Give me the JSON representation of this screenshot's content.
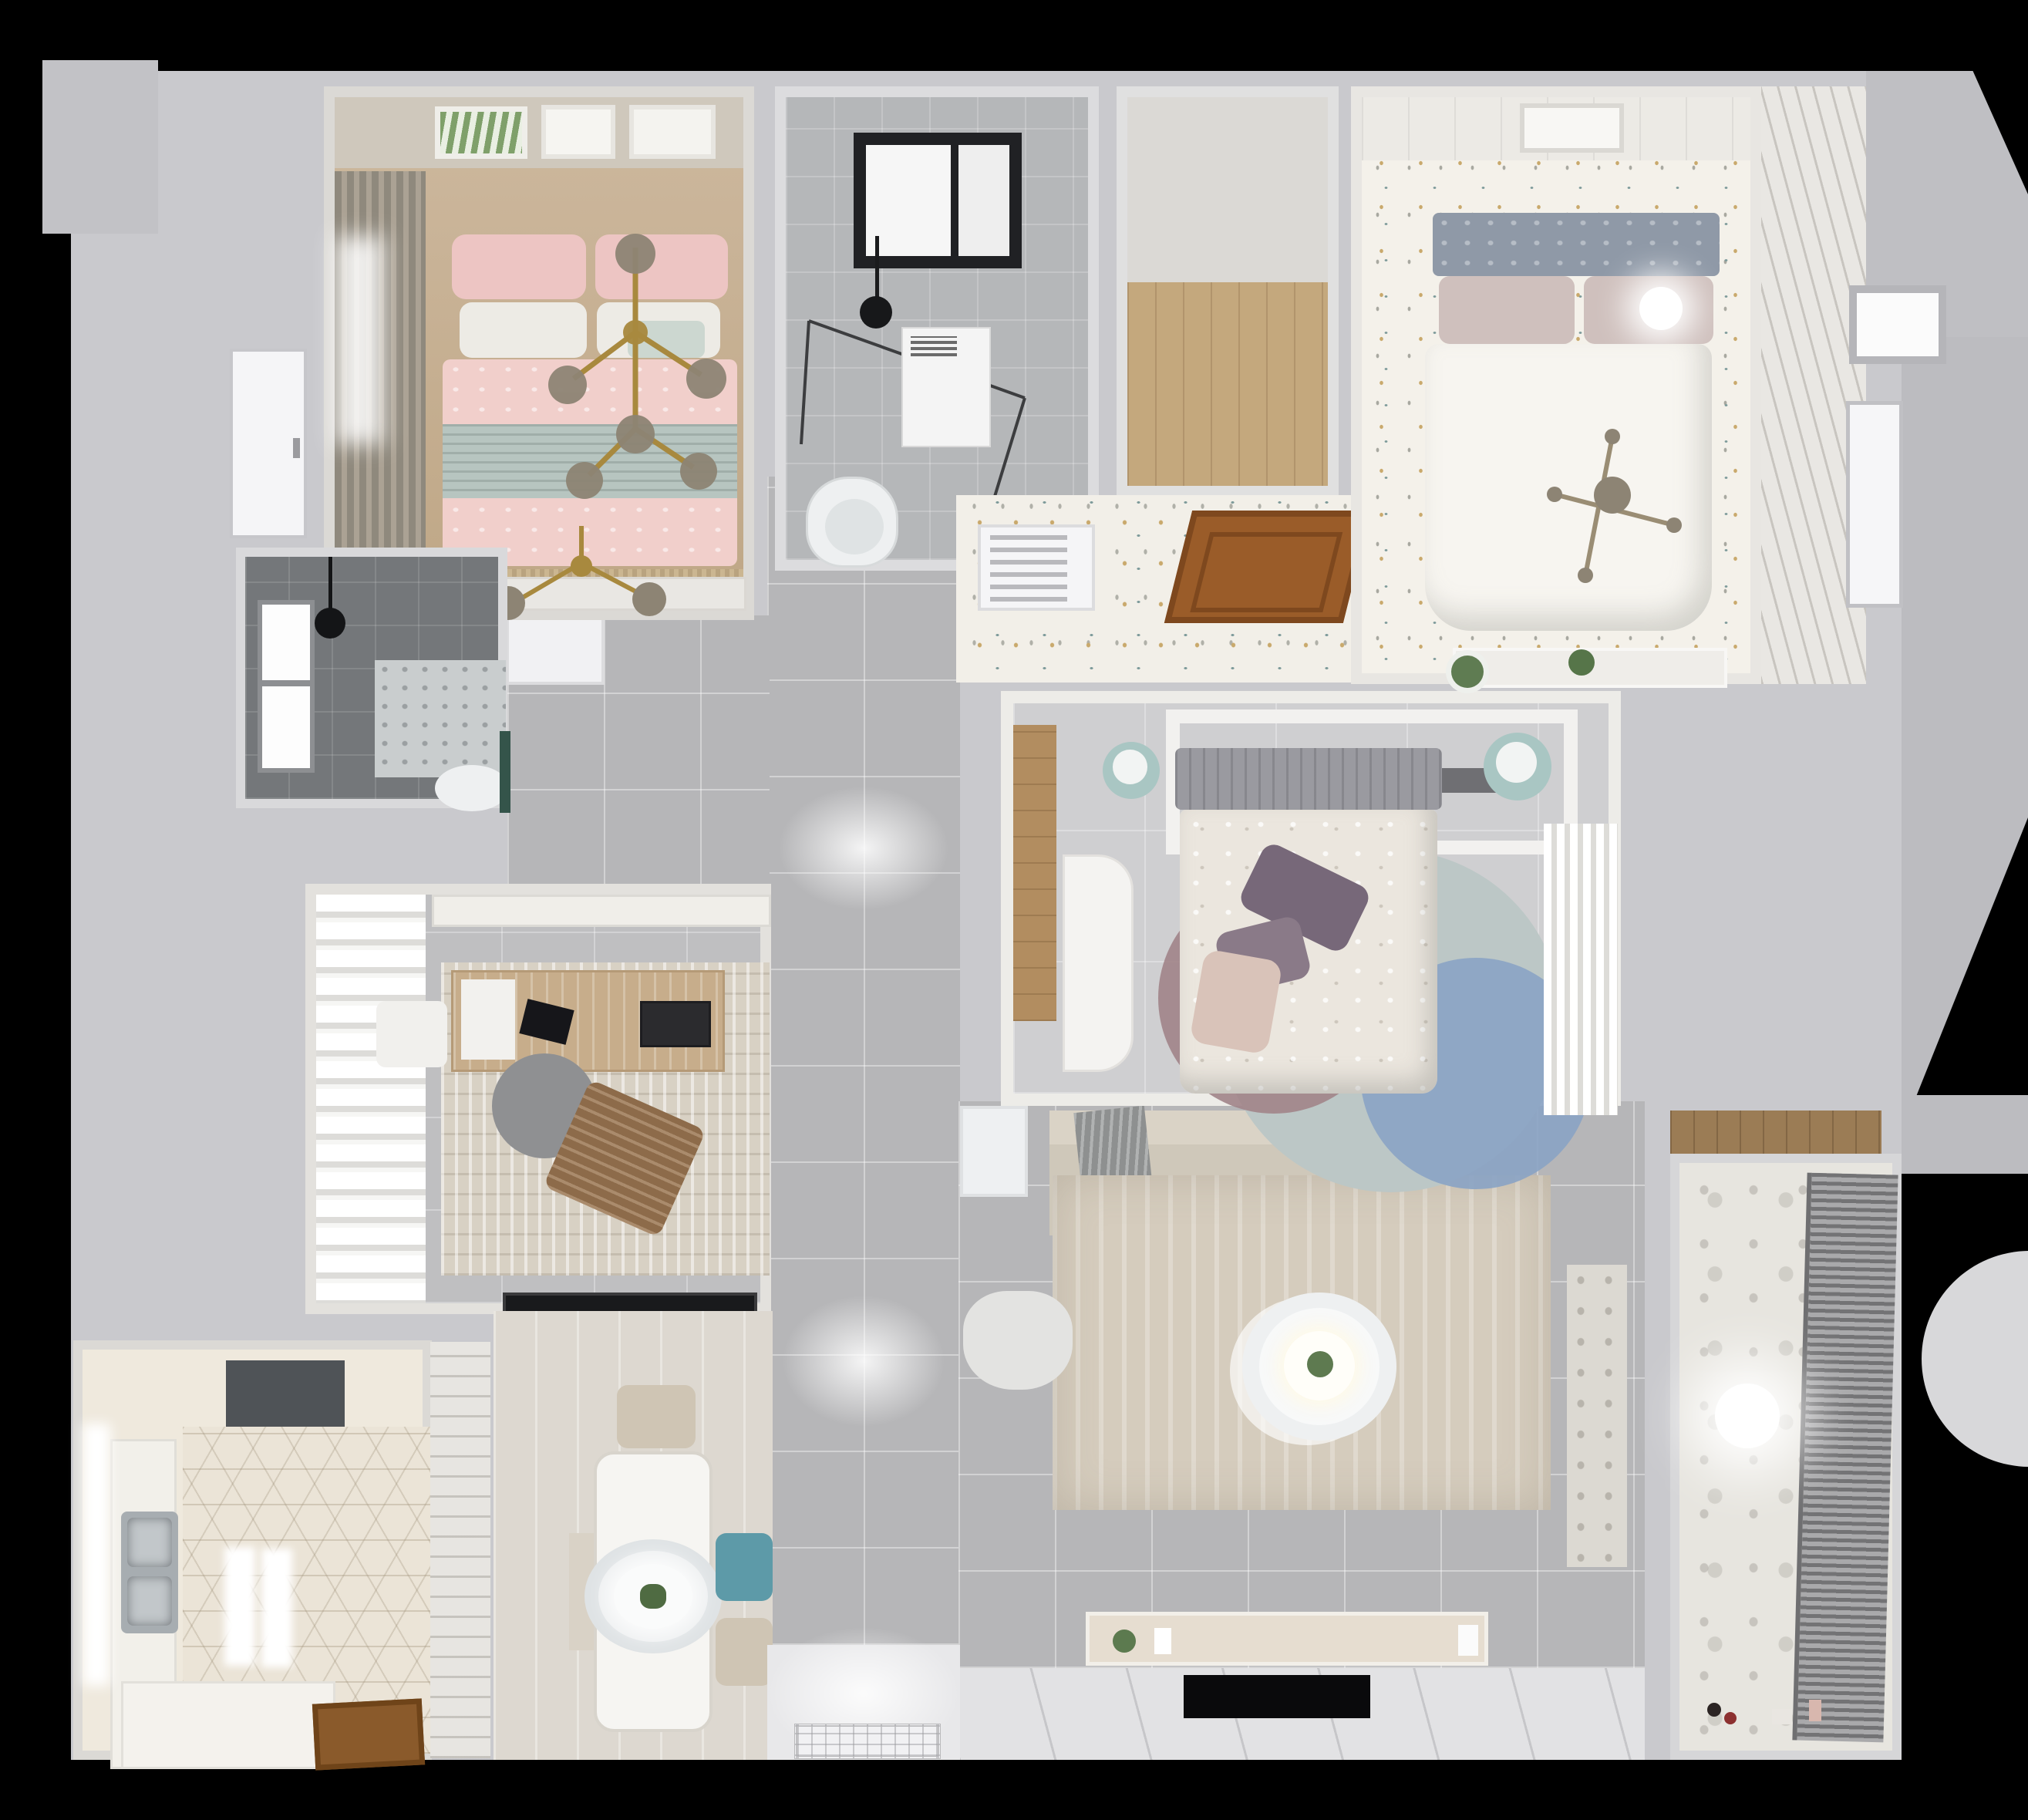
{
  "scene": {
    "type": "3d-floor-plan-top-view",
    "text_visible": "",
    "palette": {
      "background": "#000000",
      "wall_gray": "#c9c9cd",
      "wall_white": "#f2f1ef",
      "corridor_tile": "#b6b6b8",
      "speckle_floor": "#f2efe8",
      "wood_floor": "#c8b499",
      "wood_door": "#9a5c29",
      "pink_bedding": "#f1cfcb",
      "sage_throw": "#b7c5c0",
      "teal_chair": "#5d9aa8",
      "mint_pouf": "#a9c6c3",
      "purple_pillow": "#776879",
      "blue_rug": "#8aa3c4",
      "mauve_rug": "#a2868a",
      "beige_sofa": "#cfc8ba",
      "rug_beige": "#d5ccbd",
      "dark_tile": "#74777a",
      "hex_tile": "#ebe4d7",
      "blinds_gray": "#8a8a8c",
      "gold_chandelier": "#a8893e",
      "tv_black": "#0a0a0c"
    }
  },
  "rooms": [
    {
      "name": "bedroom-pink",
      "position": "top-left",
      "floor": "wood",
      "furniture": [
        "double-bed-pink-duvet",
        "pink-pillows",
        "white-pillows",
        "mint-cushion",
        "sage-throw",
        "branch-chandelier",
        "second-branch-chandelier",
        "wall-art-frames-3",
        "dark-curtains",
        "window",
        "bench",
        "fringe-rug",
        "white-door"
      ]
    },
    {
      "name": "bathroom-main",
      "position": "top-center",
      "floor": "gray-marble-tile",
      "furniture": [
        "black-framed-skylight",
        "shower-glass-enclosure",
        "black-shower-head",
        "washing-machine",
        "toilet"
      ]
    },
    {
      "name": "walk-in-closet",
      "position": "top-center-right",
      "floor": "wood-planks",
      "furniture": []
    },
    {
      "name": "foyer-hall",
      "position": "center-top",
      "floor": "speckled-terrazzo",
      "furniture": [
        "air-vent-grille",
        "open-wood-door",
        "console-shelf",
        "potted-plant"
      ]
    },
    {
      "name": "bedroom-white",
      "position": "top-right",
      "floor": "speckled-confetti",
      "furniture": [
        "double-bed-white-duvet",
        "gray-tufted-headboard",
        "blush-pillows",
        "ceiling-lamp",
        "branch-chandelier",
        "wall-art-frame",
        "paneled-wall",
        "shutter-wardrobe",
        "console-with-plant",
        "entry-door",
        "window-opening"
      ]
    },
    {
      "name": "bathroom-small",
      "position": "middle-left",
      "floor": "dark-gray-tile",
      "furniture": [
        "window",
        "rain-shower-head",
        "shower-tray-mosaic",
        "toilet",
        "green-accent"
      ]
    },
    {
      "name": "study",
      "position": "middle-left",
      "floor": "gray-tile",
      "furniture": [
        "sheer-billow-curtains",
        "wall-cabinet",
        "area-rug",
        "wood-desk",
        "papers",
        "laptop",
        "monitor",
        "white-chair",
        "gray-round-chair",
        "brown-lounge-chair",
        "black-doormat"
      ]
    },
    {
      "name": "bedroom-center",
      "position": "center",
      "floor": "light-gray-tile",
      "furniture": [
        "bed-floral-duvet",
        "gray-headboard",
        "purple-pillows",
        "blush-pillow",
        "wardrobe-frame-with-books",
        "teal-pouf-left",
        "teal-pouf-right",
        "white-desk",
        "round-layered-rug",
        "sheer-curtain-wardrobe",
        "wood-floor-strip"
      ]
    },
    {
      "name": "living-room",
      "position": "center-bottom",
      "floor": "gray-tile",
      "furniture": [
        "l-shaped-sofa",
        "gray-throw",
        "armchair",
        "side-table",
        "round-two-tier-coffee-table",
        "plant-centerpiece",
        "large-beige-rug",
        "tv-console-with-decor",
        "wall-tv",
        "patterned-tile-border"
      ]
    },
    {
      "name": "dining-area",
      "position": "bottom-center",
      "floor": "light-wood",
      "furniture": [
        "white-dining-table",
        "oval-pendant-lamp",
        "plant-centerpiece",
        "beige-chair-top",
        "teal-chair",
        "beige-chair-bottom",
        "side-bench"
      ]
    },
    {
      "name": "kitchen",
      "position": "bottom-left",
      "floor": "hexagon-tile",
      "furniture": [
        "range-hood",
        "double-stainless-sink",
        "left-counter",
        "window",
        "ceiling-light-pair",
        "bottom-counter",
        "open-wood-door",
        "slatted-pantry"
      ]
    },
    {
      "name": "balcony-laundry",
      "position": "bottom-right",
      "floor": "patterned-cement-tile",
      "furniture": [
        "venetian-blinds-window",
        "ball-pendant-lamp",
        "wood-shelf-niche",
        "toys"
      ]
    },
    {
      "name": "entry-hall",
      "position": "bottom-center",
      "floor": "white-tile",
      "furniture": [
        "ornate-doormat"
      ]
    },
    {
      "name": "corridor",
      "position": "center-spine",
      "floor": "gray-tile",
      "furniture": [
        "closet-nook"
      ]
    }
  ]
}
